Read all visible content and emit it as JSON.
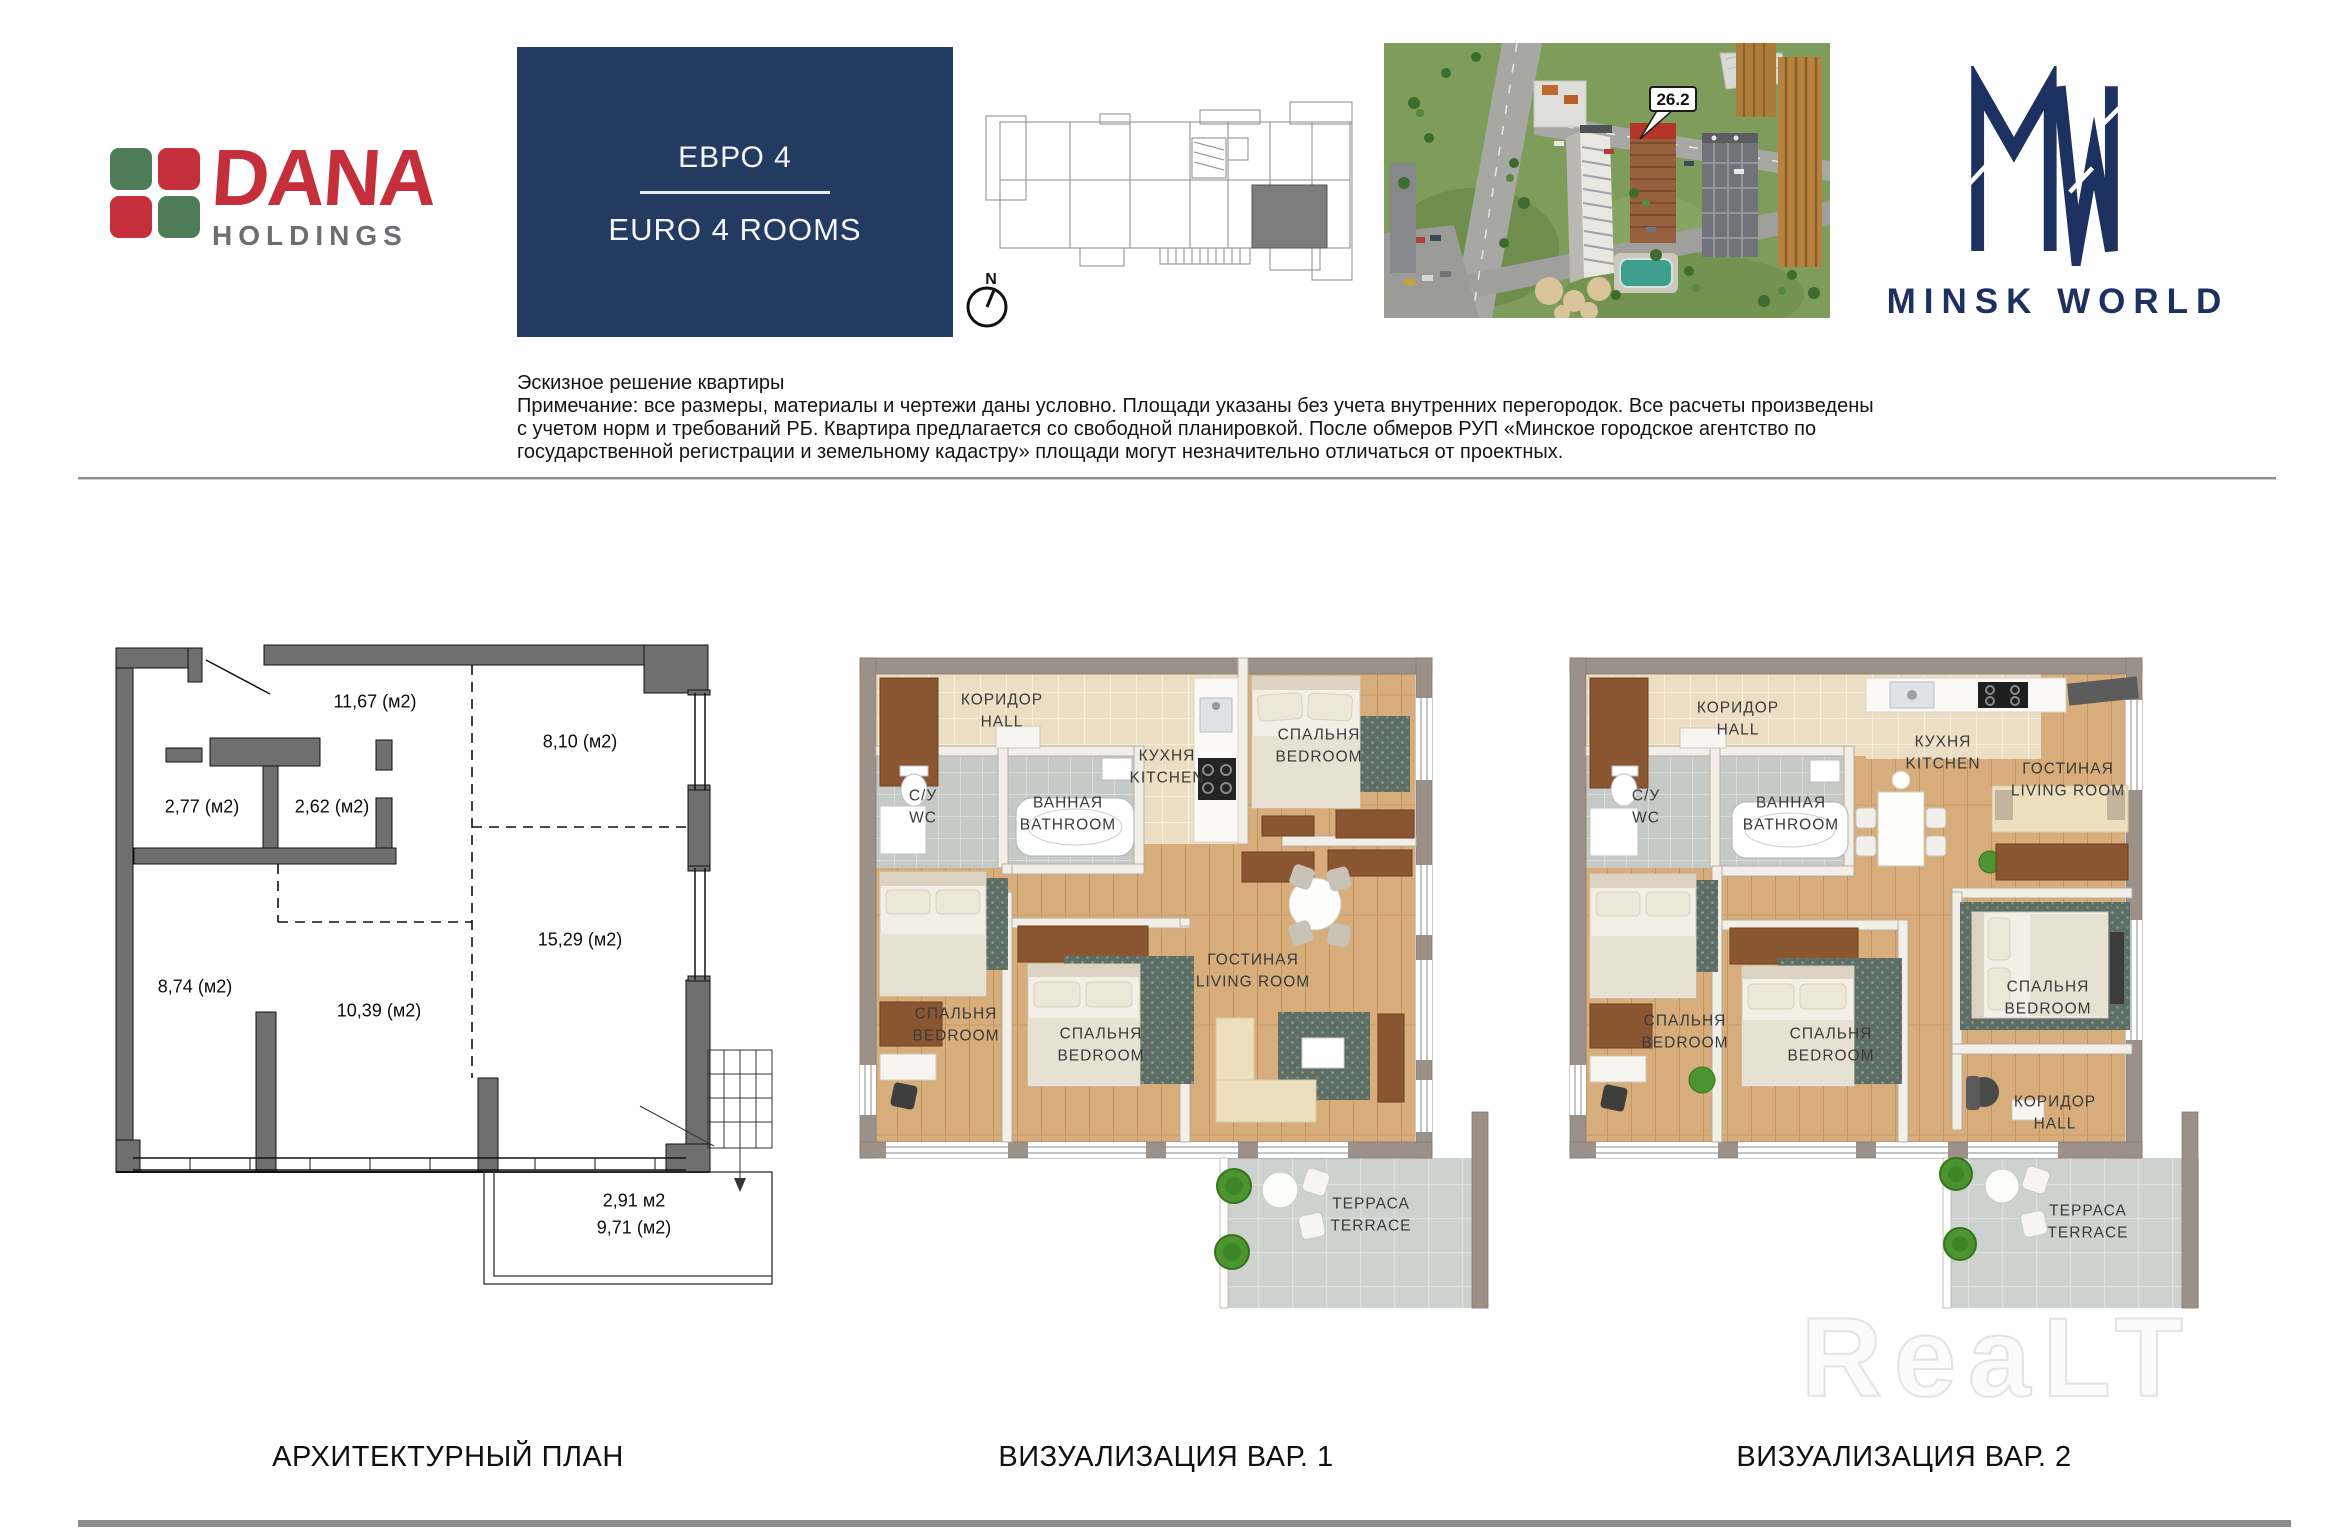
{
  "brand": {
    "dana": {
      "title": "DANA",
      "subtitle": "HOLDINGS"
    },
    "minsk_world": {
      "name": "MINSK WORLD"
    }
  },
  "title_box": {
    "ru": "ЕВРО 4",
    "en": "EURO 4 ROOMS"
  },
  "site": {
    "badge": "26.2",
    "compass": "N"
  },
  "colors": {
    "brand_red": "#c42f3b",
    "brand_green": "#4d7c57",
    "brand_gray": "#6d6e71",
    "navy_box": "#243b61",
    "mw_navy": "#1d3160",
    "highlight_red": "#b23527"
  },
  "disclaimer": {
    "title": "Эскизное решение квартиры",
    "line1": "Примечание: все размеры, материалы и чертежи даны условно. Площади указаны без учета внутренних перегородок. Все расчеты произведены",
    "line2": "с учетом норм и требований РБ. Квартира предлагается со свободной планировкой. После обмеров РУП «Минское городское агентство по",
    "line3": "государственной регистрации и земельному кадастру» площади могут незначительно отличаться от проектных."
  },
  "arch_plan": {
    "caption": "АРХИТЕКТУРНЫЙ ПЛАН",
    "areas": {
      "hall": "11,67 (м2)",
      "top_right": "8,10 (м2)",
      "wc": "2,77 (м2)",
      "bath": "2,62 (м2)",
      "left": "8,74 (м2)",
      "middle": "10,39 (м2)",
      "right": "15,29 (м2)",
      "terrace_a": "2,91 м2",
      "terrace_b": "9,71 (м2)"
    }
  },
  "viz1": {
    "caption": "ВИЗУАЛИЗАЦИЯ ВАР. 1",
    "rooms": {
      "hall": {
        "ru": "КОРИДОР",
        "en": "HALL"
      },
      "wc": {
        "ru": "С/У",
        "en": "WC"
      },
      "bath": {
        "ru": "ВАННАЯ",
        "en": "BATHROOM"
      },
      "kitchen": {
        "ru": "КУХНЯ",
        "en": "KITCHEN"
      },
      "bedroom_top": {
        "ru": "СПАЛЬНЯ",
        "en": "BEDROOM"
      },
      "bedroom_left": {
        "ru": "СПАЛЬНЯ",
        "en": "BEDROOM"
      },
      "bedroom_mid": {
        "ru": "СПАЛЬНЯ",
        "en": "BEDROOM"
      },
      "living": {
        "ru": "ГОСТИНАЯ",
        "en": "LIVING ROOM"
      },
      "terrace": {
        "ru": "ТЕРРАСА",
        "en": "TERRACE"
      }
    }
  },
  "viz2": {
    "caption": "ВИЗУАЛИЗАЦИЯ ВАР. 2",
    "rooms": {
      "hall": {
        "ru": "КОРИДОР",
        "en": "HALL"
      },
      "wc": {
        "ru": "С/У",
        "en": "WC"
      },
      "bath": {
        "ru": "ВАННАЯ",
        "en": "BATHROOM"
      },
      "kitchen": {
        "ru": "КУХНЯ",
        "en": "KITCHEN"
      },
      "living": {
        "ru": "ГОСТИНАЯ",
        "en": "LIVING ROOM"
      },
      "bedroom_left": {
        "ru": "СПАЛЬНЯ",
        "en": "BEDROOM"
      },
      "bedroom_mid": {
        "ru": "СПАЛЬНЯ",
        "en": "BEDROOM"
      },
      "bedroom_right": {
        "ru": "СПАЛЬНЯ",
        "en": "BEDROOM"
      },
      "hall2": {
        "ru": "КОРИДОР",
        "en": "HALL"
      },
      "terrace": {
        "ru": "ТЕРРАСА",
        "en": "TERRACE"
      }
    }
  },
  "watermark": "ReaLT"
}
